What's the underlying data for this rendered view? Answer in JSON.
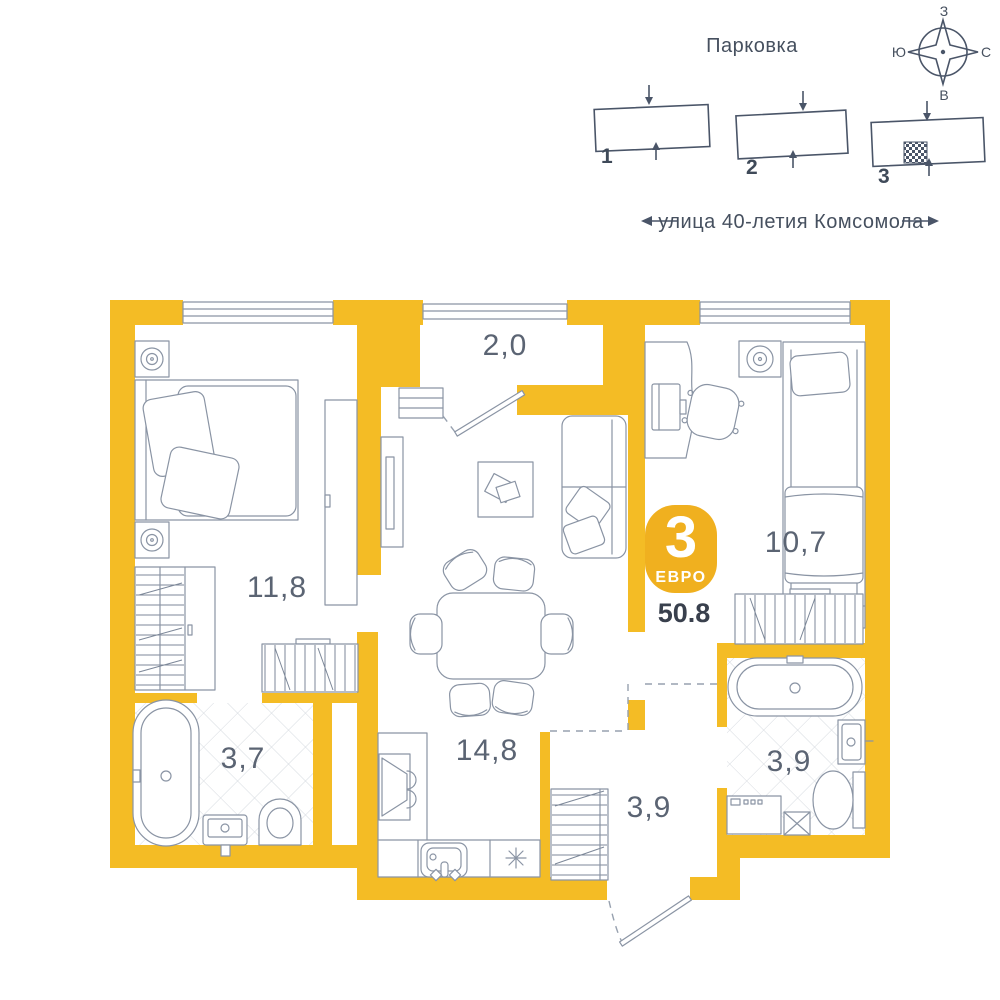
{
  "site_plan": {
    "title": "Парковка",
    "street": "улица 40-летия Комсомола",
    "compass": {
      "top": "З",
      "left": "Ю",
      "right": "С",
      "bottom": "В"
    },
    "buildings": [
      {
        "number": "1",
        "highlighted": false
      },
      {
        "number": "2",
        "highlighted": false
      },
      {
        "number": "3",
        "highlighted": true
      }
    ]
  },
  "apartment": {
    "badge": {
      "rooms_count": "3",
      "layout_type": "ЕВРО",
      "total_area": "50.8"
    },
    "room_areas": {
      "bedroom": "11,8",
      "balcony": "2,0",
      "bedroom_2": "10,7",
      "kitchen_living": "14,8",
      "bathroom": "3,7",
      "hall": "3,9",
      "bathroom_2": "3,9"
    }
  },
  "colors": {
    "wall": "#F4BC25",
    "badge": "#F0B01F",
    "furniture_line": "#8A94A4",
    "site_diagram_line": "#4A5568",
    "area_label_text": "#5B6473",
    "total_area_text": "#39404D",
    "tile_line": "#D6DAE0"
  }
}
